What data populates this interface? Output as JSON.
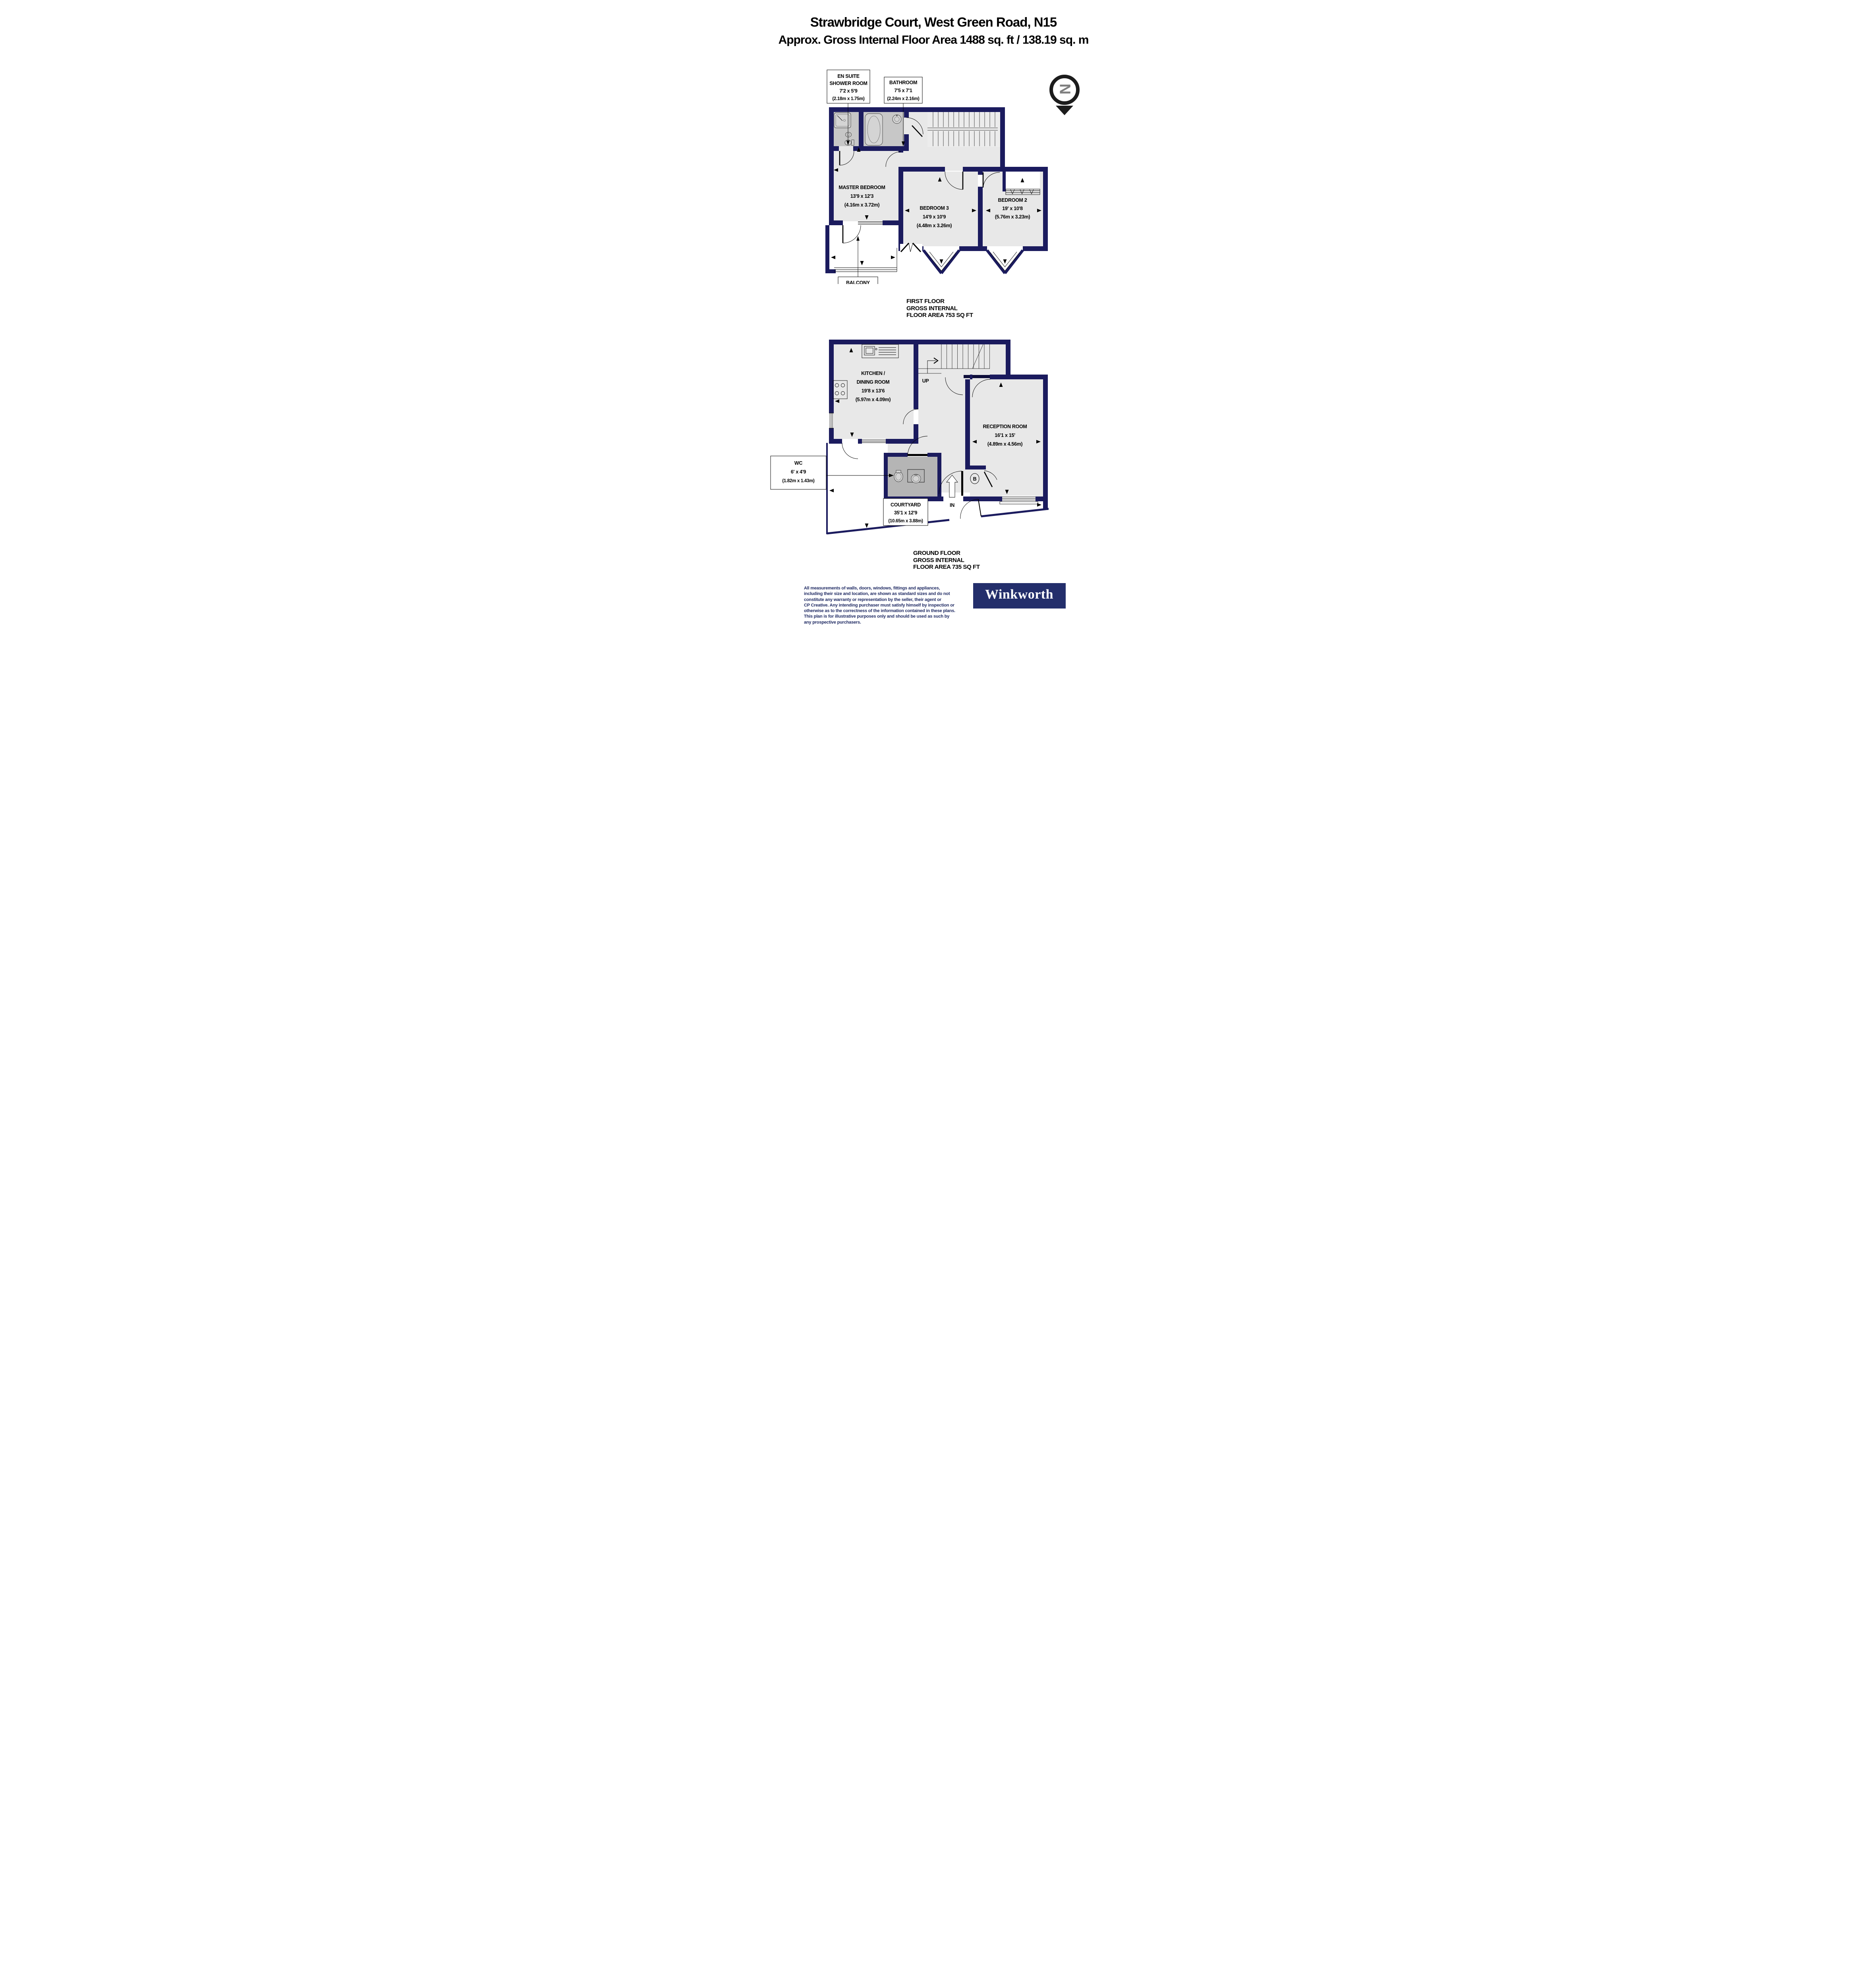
{
  "title": {
    "line1": "Strawbridge Court, West Green Road, N15",
    "line2": "Approx. Gross Internal Floor Area 1488 sq. ft / 138.19 sq. m"
  },
  "north_indicator": {
    "letter": "N"
  },
  "first_floor": {
    "caption": {
      "line1": "FIRST FLOOR",
      "line2": "GROSS INTERNAL",
      "line3": "FLOOR AREA 753 SQ FT"
    },
    "rooms": {
      "en_suite": {
        "name_line1": "EN SUITE",
        "name_line2": "SHOWER ROOM",
        "imperial": "7'2 x 5'9",
        "metric": "(2.18m x 1.75m)"
      },
      "bathroom": {
        "name": "BATHROOM",
        "imperial": "7'5 x 7'1",
        "metric": "(2.24m x 2.16m)"
      },
      "master_bedroom": {
        "name": "MASTER BEDROOM",
        "imperial": "13'9 x 12'3",
        "metric": "(4.16m x 3.72m)"
      },
      "bedroom_3": {
        "name": "BEDROOM 3",
        "imperial": "14'9 x 10'9",
        "metric": "(4.48m x 3.26m)"
      },
      "bedroom_2": {
        "name": "BEDROOM 2",
        "imperial": "19' x 10'8",
        "metric": "(5.76m x 3.23m)"
      },
      "balcony": {
        "name": "BALCONY",
        "imperial": "8'6 x 5'4",
        "metric": "(2.57m x 1.61m)"
      }
    }
  },
  "ground_floor": {
    "caption": {
      "line1": "GROUND FLOOR",
      "line2": "GROSS INTERNAL",
      "line3": "FLOOR AREA 735 SQ FT"
    },
    "rooms": {
      "kitchen_dining": {
        "name_line1": "KITCHEN /",
        "name_line2": "DINING ROOM",
        "imperial": "19'8 x 13'6",
        "metric": "(5.97m x 4.09m)"
      },
      "reception": {
        "name": "RECEPTION ROOM",
        "imperial": "16'1 x 15'",
        "metric": "(4.89m x 4.56m)"
      },
      "wc": {
        "name": "WC",
        "imperial": "6' x 4'9",
        "metric": "(1.82m x 1.43m)"
      },
      "courtyard": {
        "name": "COURTYARD",
        "imperial": "35'1 x 12'9",
        "metric": "(10.65m x 3.88m)"
      }
    },
    "annotations": {
      "up": "UP",
      "in": "IN",
      "boiler": "B"
    }
  },
  "disclaimer": {
    "line1": "All measurements of walls, doors, windows, fittings and appliances,",
    "line2": "including their size and location, are shown as standard sizes and do not",
    "line3": "constitute any warranty or representation by the seller, their agent or",
    "line4": "CP Creative. Any intending purchaser must satisfy himself by inspection or",
    "line5": "otherwise as to the correctness of the information contained in these plans.",
    "line6": "This plan is for illustrative purposes only and should be used as such by",
    "line7": "any prospective purchasers."
  },
  "brand": {
    "name": "Winkworth"
  },
  "colors": {
    "wall": "#1b1b5e",
    "room_fill": "#e8e8e8",
    "wet_room_fill": "#c7c7c7",
    "wc_room_fill": "#b5b5b5",
    "logo_background": "#232e6b",
    "disclaimer_text": "#1f2a63",
    "north_letter": "#7f7f7f"
  }
}
